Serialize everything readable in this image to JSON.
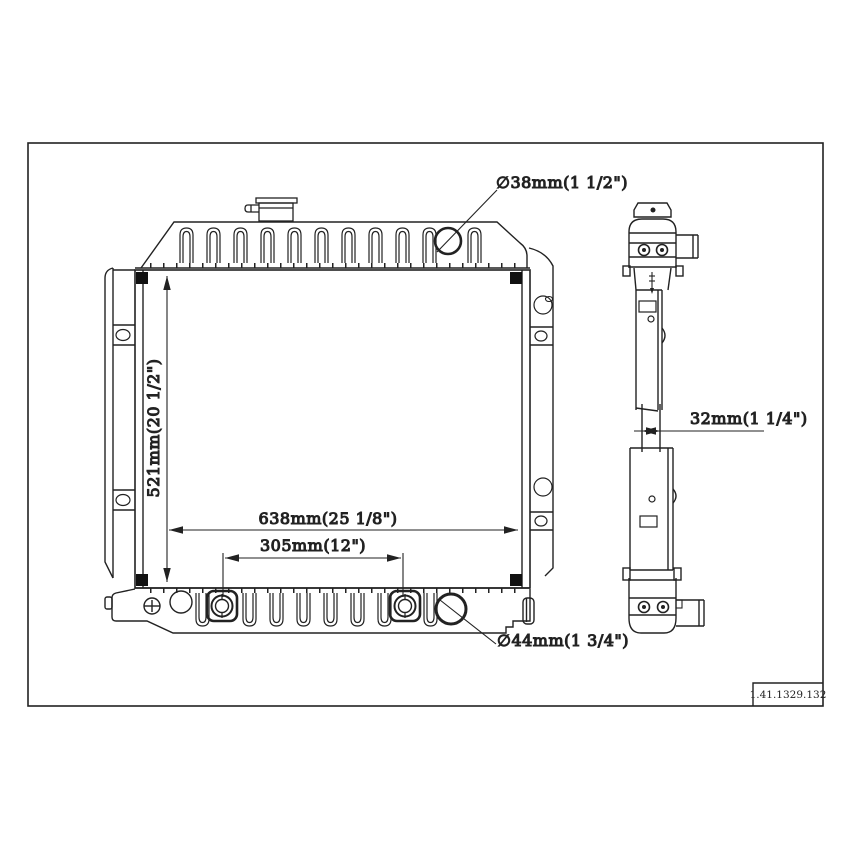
{
  "title_block": {
    "part_number": "1.41.1329.132"
  },
  "dimensions": {
    "inlet": "∅38mm(1 1/2\")",
    "height": "521mm(20 1/2\")",
    "width": "638mm(25 1/8\")",
    "fitting_spacing": "305mm(12\")",
    "outlet": "∅44mm(1 3/4\")",
    "core_thickness": "32mm(1 1/4\")"
  },
  "colors": {
    "line": "#222222",
    "background": "#ffffff"
  }
}
